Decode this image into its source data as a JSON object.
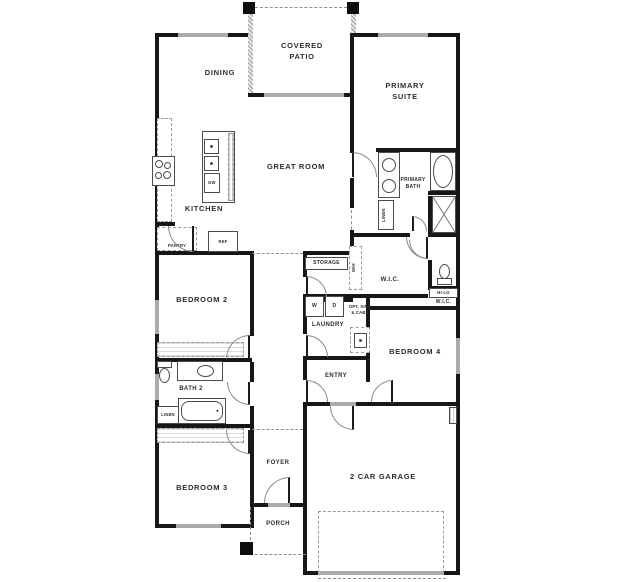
{
  "floorplan": {
    "labels": {
      "dining": "DINING",
      "covered_patio": "COVERED PATIO",
      "primary_suite": "PRIMARY SUITE",
      "great_room": "GREAT ROOM",
      "kitchen": "KITCHEN",
      "primary_bath": "PRIMARY BATH",
      "pantry": "PANTRY",
      "ref": "REF",
      "dw": "DW",
      "storage": "STORAGE",
      "linen_primary": "LINEN",
      "wh": "W/H",
      "wic_primary": "W.I.C.",
      "hi_lo": "HI-LO",
      "wic_secondary": "W.I.C.",
      "bedroom2": "BEDROOM 2",
      "washer": "W",
      "dryer": "D",
      "laundry": "LAUNDRY",
      "opt_sink": "OPT. SINK & CABS",
      "bedroom4": "BEDROOM 4",
      "bath2": "BATH 2",
      "linen_bath2": "LINEN",
      "entry": "ENTRY",
      "bedroom3": "BEDROOM 3",
      "foyer": "FOYER",
      "porch": "PORCH",
      "garage": "2 CAR GARAGE"
    },
    "colors": {
      "wall": "#171717",
      "window": "#ababab",
      "dashed_line": "#8e8e8e",
      "text": "#2d2d2d",
      "background": "#ffffff"
    }
  }
}
